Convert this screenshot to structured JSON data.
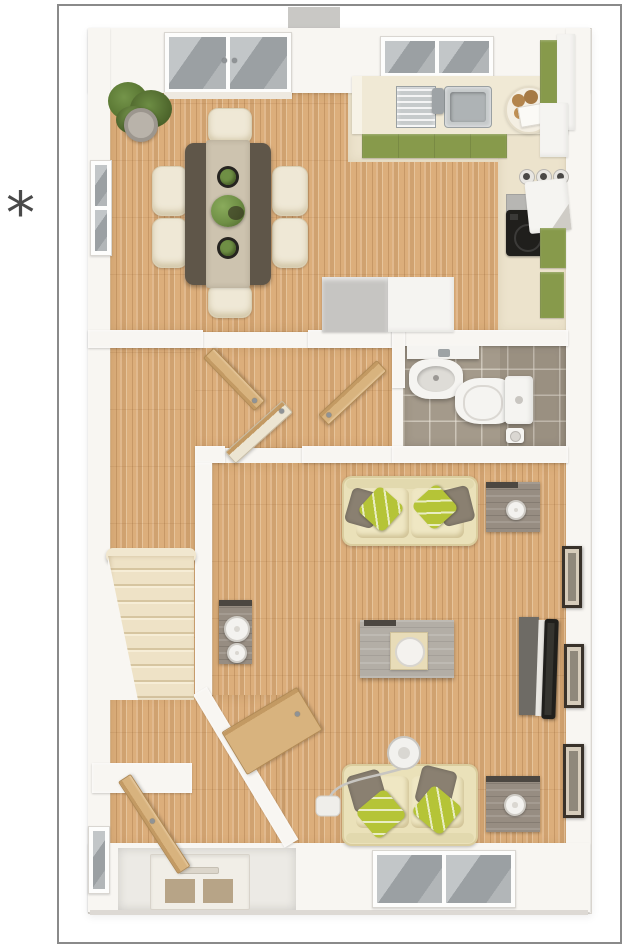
{
  "annotation": {
    "symbol": "*"
  },
  "colors": {
    "page_bg": "#ffffff",
    "frame_line": "#8a8a8a",
    "ink": "#4a4a4a",
    "wall": "#f8f6f2",
    "wood": "#dcae7b",
    "cream_floor": "#ece3cc",
    "worktop": "#f0e9d5",
    "cabinet_green": "#879a4b",
    "steel": "#c6cacb",
    "tile": "#a49a8b",
    "fixture_white": "#f5f4f1",
    "sofa_cream": "#eae1b9",
    "cushion_cream": "#efe7c3",
    "chair_cream": "#efe8d6",
    "pillow_lime": "#b5c437",
    "pillow_taupe": "#8a8071",
    "table_brown": "#5f5649",
    "runner_beige": "#cdc3af",
    "gray_wood": "#b3aea6",
    "dark_trim": "#4c4741",
    "tv_black": "#201f1c",
    "frame_dark": "#39322a",
    "frame_mat": "#d6ccbb",
    "door_wood": "#d8b37e",
    "glass_gray": "#a9adb0",
    "plant_green": "#6f8f45",
    "plant_dark": "#4a6129",
    "pot_gray": "#9c968e",
    "box_gray": "#c6c5c2",
    "roof_gray": "#c9c8c5",
    "tan_glass": "#b7a487"
  }
}
